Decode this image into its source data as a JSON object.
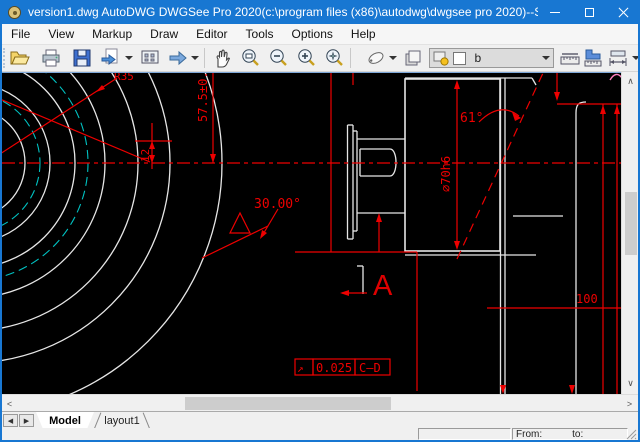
{
  "window": {
    "title": "version1.dwg AutoDWG DWGSee Pro 2020(c:\\program files (x86)\\autodwg\\dwgsee pro 2020)--Single user lic...",
    "controls": [
      "minimize",
      "maximize",
      "close"
    ]
  },
  "menu": {
    "items": [
      "File",
      "View",
      "Markup",
      "Draw",
      "Editor",
      "Tools",
      "Options",
      "Help"
    ]
  },
  "toolbar": {
    "icons": [
      "open",
      "print",
      "save",
      "convert",
      "thumbnail-view",
      "forward-arrow",
      "pan-hand",
      "zoom-window",
      "zoom-out",
      "zoom-in",
      "zoom-extents",
      "markup-pen",
      "layers",
      "measure-length",
      "measure-area",
      "measure-dimension"
    ],
    "layer_combo": {
      "value": "b"
    }
  },
  "drawing": {
    "labels": {
      "radius": "R35",
      "height": "57.5±0.2",
      "offset": "12",
      "angle30": "30.00°",
      "angle61": "61°",
      "diameter": "⌀70h6",
      "length100": "100",
      "section_letter": "A",
      "fcf_symbol": "↗",
      "fcf_tolerance": "0.025",
      "fcf_datum": "C–D"
    }
  },
  "scrollbars": {
    "up": "∧",
    "down": "∨",
    "left": "<",
    "right": ">"
  },
  "tabs": {
    "prev": "◀",
    "next": "▶",
    "items": [
      {
        "label": "Model",
        "active": true
      },
      {
        "label": "layout1",
        "active": false
      }
    ]
  },
  "statusbar": {
    "from_label": "From:",
    "to_label": "to:"
  },
  "colors": {
    "titlebar": "#1877d2",
    "canvas_bg": "#000000",
    "dimension": "#ee0000",
    "geometry": "#e6e6e6",
    "centerline_cyan": "#00c2c2",
    "highlight_pink": "#ff7fbf"
  }
}
